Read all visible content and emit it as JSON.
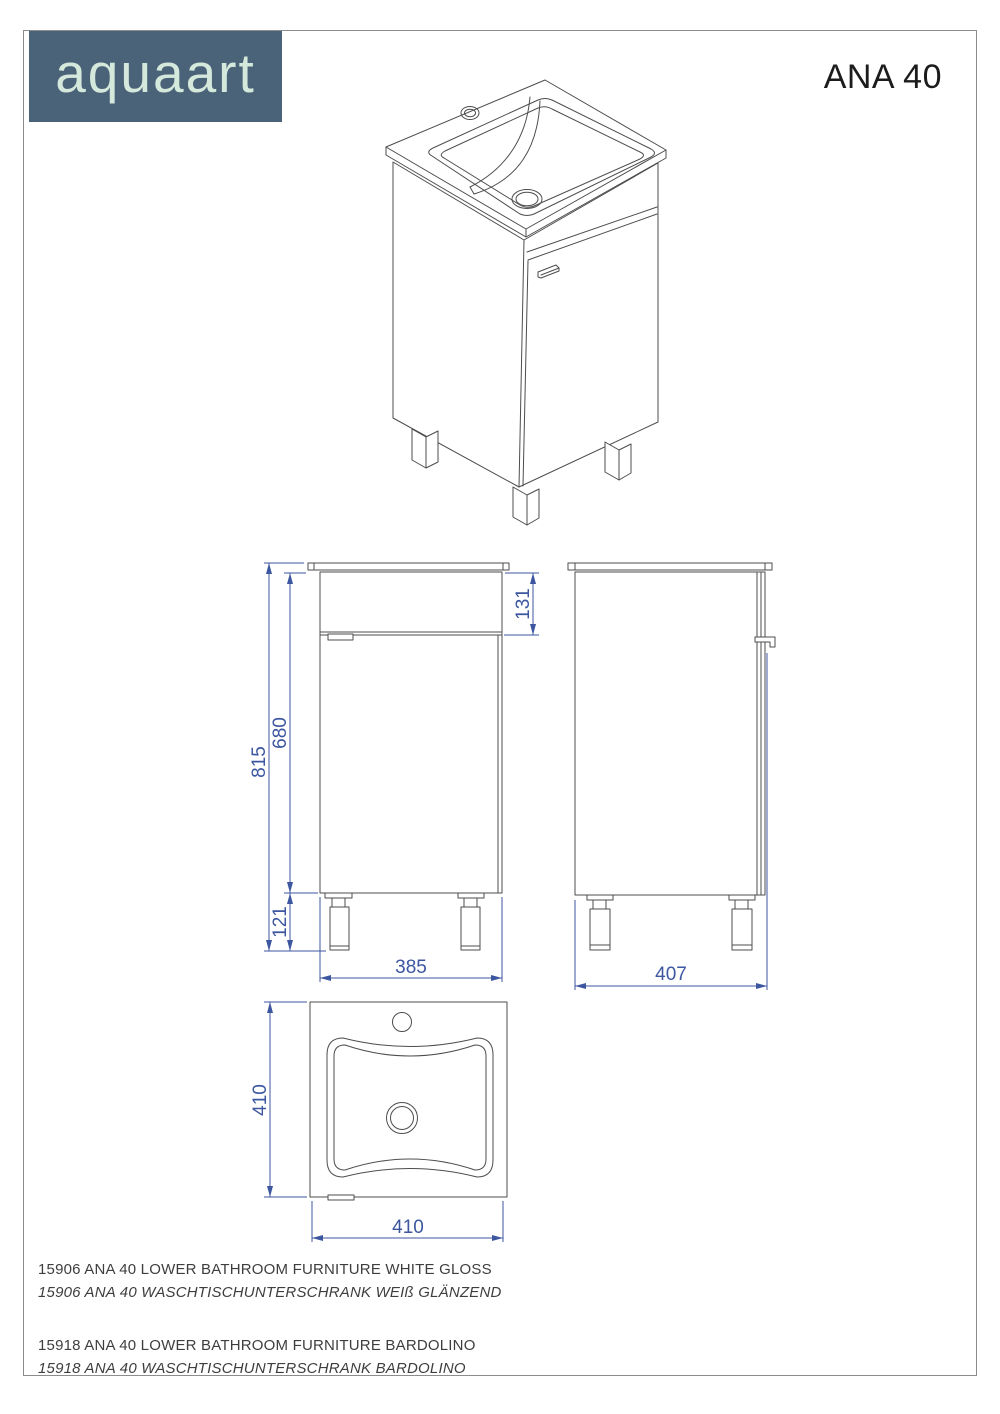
{
  "header": {
    "brand": "aquaart",
    "title": "ANA 40"
  },
  "dimensions": {
    "front": {
      "total_height": "815",
      "body_height": "680",
      "top_height": "131",
      "leg_height": "121",
      "width": "385"
    },
    "side": {
      "depth": "407"
    },
    "top": {
      "height": "410",
      "width": "410"
    }
  },
  "footer": {
    "products": [
      {
        "en": "15906 ANA 40 LOWER BATHROOM FURNITURE WHITE GLOSS",
        "de": "15906 ANA 40 WASCHTISCHUNTERSCHRANK WEIß GLÄNZEND"
      },
      {
        "en": "15918 ANA 40 LOWER BATHROOM FURNITURE BARDOLINO",
        "de": "15918 ANA 40 WASCHTISCHUNTERSCHRANK BARDOLINO"
      }
    ]
  },
  "colors": {
    "dim": "#3c56a0",
    "line": "#4d4d4d",
    "border": "#8c8c8c",
    "logo-bg": "#4b6379",
    "logo-text": "#d4e9dc",
    "text": "#3e3e3e",
    "title": "#1c1c1c"
  }
}
